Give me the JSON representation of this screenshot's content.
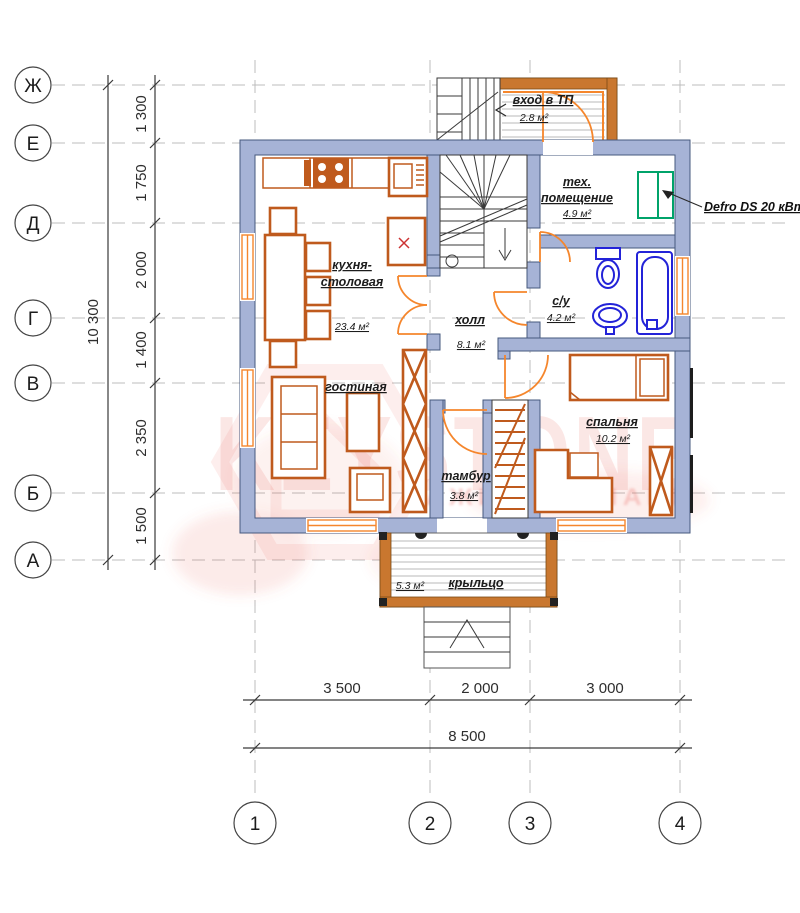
{
  "axes": {
    "rows": [
      {
        "label": "Ж"
      },
      {
        "label": "Е"
      },
      {
        "label": "Д"
      },
      {
        "label": "Г"
      },
      {
        "label": "В"
      },
      {
        "label": "Б"
      },
      {
        "label": "А"
      }
    ],
    "cols": [
      {
        "label": "1"
      },
      {
        "label": "2"
      },
      {
        "label": "3"
      },
      {
        "label": "4"
      }
    ]
  },
  "dimensions": {
    "vertical": {
      "total": "10 300",
      "segments": [
        "1 300",
        "1 750",
        "2 000",
        "1 400",
        "2 350",
        "1 500"
      ]
    },
    "horizontal": {
      "total": "8 500",
      "segments": [
        "3 500",
        "2 000",
        "3 000"
      ]
    }
  },
  "rooms": {
    "entry_tp": {
      "name": "вход в ТП",
      "area": "2.8 м²"
    },
    "tech": {
      "line1": "тех.",
      "line2": "помещение",
      "area": "4.9 м²"
    },
    "bath": {
      "name": "с/у",
      "area": "4.2 м²"
    },
    "kitchen": {
      "line1": "кухня-",
      "line2": "столовая",
      "area": "23.4 м²"
    },
    "hall": {
      "name": "холл",
      "area": "8.1 м²"
    },
    "living": {
      "name": "гостиная"
    },
    "bedroom": {
      "name": "спальня",
      "area": "10.2 м²"
    },
    "tambour": {
      "name": "тамбур",
      "area": "3.8 м²"
    },
    "porch": {
      "name": "крыльцо",
      "area": "5.3 м²"
    }
  },
  "annotations": {
    "boiler_label": "Defro DS 20 кВт"
  },
  "watermark": {
    "brand": "KEYSTONE",
    "tagline_fragment": "АЖИ З КОМАНИ"
  },
  "colors": {
    "wall": "#a6b3d6",
    "wallStroke": "#46587e",
    "furniture": "#bf5a1d",
    "door": "#f5862c",
    "plumbing": "#2323d8",
    "boiler": "#00a36a",
    "watermark": "#e85a52",
    "wood": "#c9772f"
  }
}
